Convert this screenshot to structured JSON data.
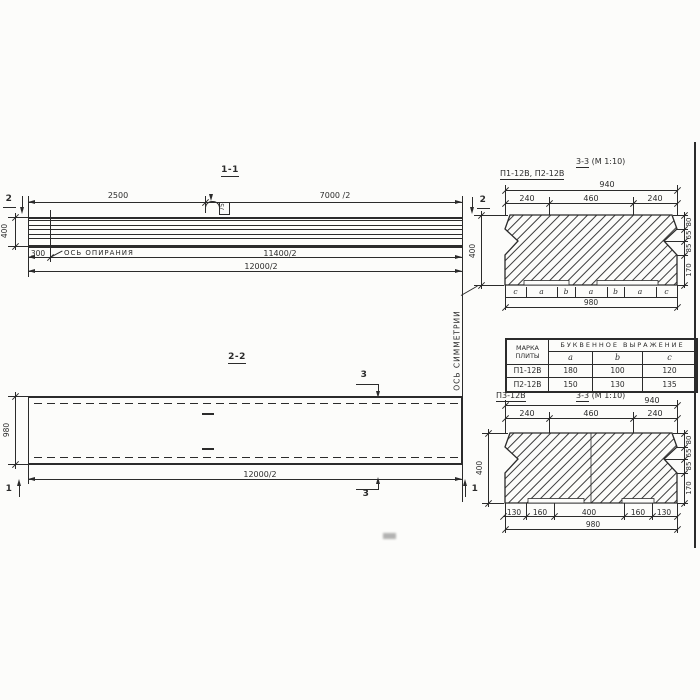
{
  "colors": {
    "ink": "#2b2b2b",
    "paper": "#fcfcfa"
  },
  "s11": {
    "title": "1-1",
    "dim_2500": "2500",
    "dim_7000": "7000 /2",
    "dim_400": "400",
    "dim_300": "300",
    "support_axis_label": "ОСЬ ОПИРАНИЯ",
    "dim_11400": "11400/2",
    "dim_12000": "12000/2",
    "marker_left": "2",
    "marker_right": "2",
    "loop_tag": "75"
  },
  "s22": {
    "title": "2-2",
    "dim_980": "980",
    "dim_12000": "12000/2",
    "marker_3_top": "3",
    "marker_3_bottom": "3",
    "marker_1_left": "1",
    "marker_1_right": "1"
  },
  "axis_symmetry_label": "ОСЬ СИММЕТРИИ",
  "s33a": {
    "marks_label": "П1-12В, П2-12В",
    "title": "3-3",
    "scale": "(М 1:10)",
    "dim_940": "940",
    "dim_240l": "240",
    "dim_460": "460",
    "dim_240r": "240",
    "dim_400": "400",
    "dim_80": "80",
    "dim_65": "65",
    "dim_85": "85",
    "dim_170": "170",
    "letters": [
      "c",
      "a",
      "b",
      "a",
      "b",
      "a",
      "c"
    ],
    "dim_980": "980"
  },
  "table": {
    "header_mark_line1": "МАРКА",
    "header_mark_line2": "ПЛИТЫ",
    "header_group": "БУКВЕННОЕ ВЫРАЖЕНИЕ",
    "col_a": "a",
    "col_b": "b",
    "col_c": "c",
    "rows": [
      {
        "mark": "П1-12В",
        "a": "180",
        "b": "100",
        "c": "120"
      },
      {
        "mark": "П2-12В",
        "a": "150",
        "b": "130",
        "c": "135"
      }
    ]
  },
  "s33b": {
    "marks_label": "П3-12В",
    "title": "3-3",
    "scale": "(М 1:10)",
    "dim_940": "940",
    "dim_240l": "240",
    "dim_460": "460",
    "dim_240r": "240",
    "dim_400": "400",
    "dim_80": "80",
    "dim_65": "65",
    "dim_85": "85",
    "dim_170": "170",
    "dims_bottom": [
      "130",
      "160",
      "400",
      "160",
      "130"
    ],
    "dim_980": "980"
  }
}
